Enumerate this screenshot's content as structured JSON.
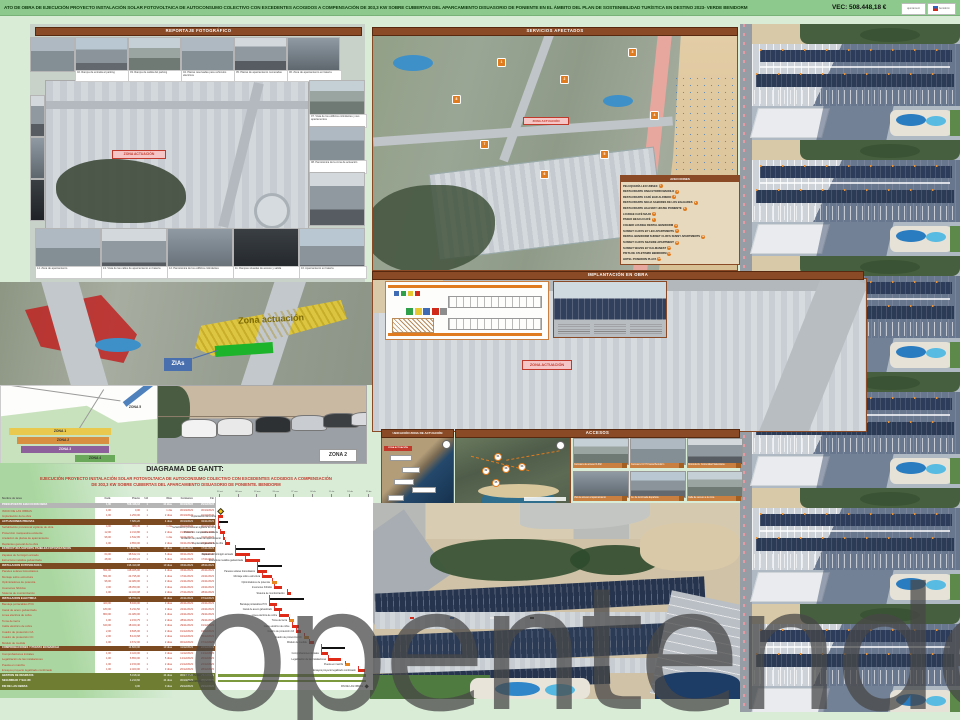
{
  "header": {
    "title": "ATO DE OBRA DE EJECUCIÓN PROYECTO INSTALACIÓN SOLAR FOTOVOLTAICA DE AUTOCONSUMO COLECTIVO CON EXCEDENTES ACOGIDOS A COMPENSACIÓN DE 303,3 KW SOBRE CUBIERTAS DEL APARCAMIENTO DISUASORIO DE PONIENTE EN EL ÁMBITO DEL PLAN DE SOSTENIBILIDAD TURÍSTICA EN DESTINO 2023- VERDE BENIDORM",
    "vec": "VEC: 508.448,18 €",
    "logo1": "ajuntament",
    "logo2": "benidorm"
  },
  "panels": {
    "reportaje": {
      "title": "REPORTAJE FOTOGRÁFICO",
      "zona_label": "ZONA ACTUACIÓN",
      "top_row": [
        "02. Rampa de entrada al parking",
        "03. Rampa de salida del parking",
        "04. Plazas reservadas para vehículos eléctricos",
        "05. Plazas de aparcamiento numeradas",
        "06. Zona de aparcamiento en batería"
      ],
      "right_col": [
        "07. Vista de los edificios colindantes y sus apartamentos",
        "08. Panorámica de la zona de actuación"
      ],
      "bottom_row": [
        "14. Zona de aparcamiento",
        "13. Vista de las calles de aparcamiento en batería",
        "12. Panorámica de los edificios colindantes",
        "11. Rampas situadas de acceso y salida",
        "16. Aparcamiento en batería"
      ]
    },
    "servicios": {
      "title": "SERVICIOS AFECTADOS",
      "zona_label": "ZONA ACTUACIÓN",
      "afecciones": {
        "title": "AFECCIONES",
        "items": [
          {
            "n": "1",
            "label": "PELUQUERÍA LEO UNISEX"
          },
          {
            "n": "2",
            "label": "RESTAURANTE ONGI ETORRI MANOLO"
          },
          {
            "n": "3",
            "label": "RESTAURANTE CAFÉ BAR ALFREDO"
          },
          {
            "n": "4",
            "label": "RESTAURANTE SIGUA SABORES DE LOS BALEARES"
          },
          {
            "n": "5",
            "label": "RESTAURANTE HALFWAY HOUSE PONIENTE"
          },
          {
            "n": "6",
            "label": "LOUNGE CAFÉ MAJO"
          },
          {
            "n": "7",
            "label": "PASEO BEACH CAFÉ"
          },
          {
            "n": "8",
            "label": "COLIBRI LOUNGE RENTAL BENIDORM"
          },
          {
            "n": "9",
            "label": "SUNSET CLIFFS BY LEO APARTMENTS"
          },
          {
            "n": "10",
            "label": "RENTAL BENIDORM SUNSET CLIFFS SUNNY APARTMENTS"
          },
          {
            "n": "11",
            "label": "SUNSET CLIFFS SEASIDE APARTMENT"
          },
          {
            "n": "12",
            "label": "SUNSET WAVES BY KALMANEST"
          },
          {
            "n": "13",
            "label": "PISTA DE ATLETISMO BENIDORM"
          },
          {
            "n": "14",
            "label": "HOTEL POSEIDON PLAYA"
          }
        ]
      },
      "markers": [
        {
          "n": "1",
          "x": 497,
          "y": 58
        },
        {
          "n": "2",
          "x": 560,
          "y": 75
        },
        {
          "n": "3",
          "x": 628,
          "y": 48
        },
        {
          "n": "4",
          "x": 650,
          "y": 111
        },
        {
          "n": "5",
          "x": 600,
          "y": 150
        },
        {
          "n": "6",
          "x": 540,
          "y": 170
        },
        {
          "n": "7",
          "x": 480,
          "y": 140
        },
        {
          "n": "8",
          "x": 452,
          "y": 95
        }
      ]
    },
    "implantacion": {
      "title": "IMPLANTACIÓN EN OBRA",
      "zona_label": "ZONA ACTUACIÓN"
    },
    "overlay": {
      "zona_actuacion": "Zona actuación",
      "zias": "ZIAs"
    },
    "zonas": {
      "z1": "ZONA 1",
      "z2": "ZONA 2",
      "z3": "ZONA 3",
      "z4": "ZONA 4",
      "z5": "ZONA 5",
      "photo_label": "ZONA 2"
    },
    "ubicacion": {
      "title": "UBICACIÓN ZONA DE ACTUACIÓN",
      "chip": "ZONA ACTUACIÓN"
    },
    "accesos": {
      "title": "ACCESOS",
      "photos": [
        "Carretera de acceso N-332",
        "Carretera CV-70 hacia Benidorm",
        "Rotonda Av. Comunidad Valenciana",
        "Vial de acceso al aparcamiento",
        "Av. de la Armada Española",
        "Calle de acceso a la zona"
      ],
      "markers": [
        "01",
        "02",
        "03",
        "04",
        "05"
      ]
    }
  },
  "gantt": {
    "title": "DIAGRAMA DE GANTT:",
    "subtitle1": "EJECUCIÓN PROYECTO INSTALACIÓN SOLAR FOTOVOLTAICA DE AUTOCONSUMO COLECTIVO CON EXCEDENTES ACOGIDOS A COMPENSACIÓN",
    "subtitle2": "DE 303,3 KW SOBRE CUBIERTAS DEL APARCAMIENTO DISUASORIO DE PONIENTE. BENIDORM",
    "columns": [
      "Nombre de tarea",
      "Cant.",
      "Precio",
      "Ud",
      "Días",
      "Comienzo",
      "Fin"
    ],
    "unit": "1",
    "ticks": [
      "30 oct",
      "06 nov",
      "13 nov",
      "20 nov",
      "27 nov",
      "04 dic",
      "11 dic",
      "18 dic",
      "25 dic"
    ],
    "total": {
      "t": "total",
      "l": "PRESUPUESTO EJECUCIÓN OBRA",
      "q": "1,00",
      "p": "508.448,18",
      "d": "44 días",
      "s": "30/10/2023",
      "e": "29/12/2023"
    },
    "rows": [
      {
        "t": "task",
        "l": "INICIO DE LAS OBRAS",
        "q": "1,00",
        "p": "0,00",
        "d": "1 día",
        "s": "30/10/2023",
        "e": "30/10/2023",
        "m": "start"
      },
      {
        "t": "task",
        "l": "Implantación de la obra",
        "q": "1,00",
        "p": "1.250,00",
        "d": "2 días",
        "s": "30/10/2023",
        "e": "31/10/2023"
      },
      {
        "t": "sec",
        "l": "ACTUACIONES PREVIAS",
        "p": "7.684,20",
        "d": "4 días",
        "s": "30/10/2023",
        "e": "02/11/2023"
      },
      {
        "t": "task",
        "l": "Señalización provisional vigilante de obra",
        "q": "4,00",
        "p": "980,45",
        "d": "1 día",
        "s": "30/10/2023",
        "e": "30/10/2023"
      },
      {
        "t": "task",
        "l": "Protección marquesina existente",
        "q": "12,00",
        "p": "2.310,80",
        "d": "2 días",
        "s": "31/10/2023",
        "e": "01/11/2023"
      },
      {
        "t": "task",
        "l": "Anulación de plazas de aparcamiento",
        "q": "96,00",
        "p": "1.542,95",
        "d": "1 día",
        "s": "01/11/2023",
        "e": "01/11/2023"
      },
      {
        "t": "task",
        "l": "Replanteo general de la obra",
        "q": "1,00",
        "p": "2.850,00",
        "d": "2 días",
        "s": "02/11/2023",
        "e": "03/11/2023"
      },
      {
        "t": "sec",
        "l": "ESTRUCTURA SOPORTE PANELES FOTOVOLTAICOS",
        "p": "178.902,55",
        "d": "12 días",
        "s": "06/11/2023",
        "e": "17/11/2023"
      },
      {
        "t": "task",
        "l": "Zapatas de hormigón armado",
        "q": "64,00",
        "p": "38.642,31",
        "d": "6 días",
        "s": "06/11/2023",
        "e": "13/11/2023"
      },
      {
        "t": "task",
        "l": "Estructura metálica galvanizada",
        "q": "48,00",
        "p": "140.260,24",
        "d": "6 días",
        "s": "10/11/2023",
        "e": "17/11/2023"
      },
      {
        "t": "sec",
        "l": "INSTALACIÓN FOTOVOLTAICA",
        "p": "196.410,08",
        "d": "10 días",
        "s": "15/11/2023",
        "e": "28/11/2023"
      },
      {
        "t": "task",
        "l": "Paneles solares fotovoltaicos",
        "q": "551,00",
        "p": "118.465,00",
        "d": "4 días",
        "s": "15/11/2023",
        "e": "20/11/2023"
      },
      {
        "t": "task",
        "l": "Montaje sobre estructura",
        "q": "551,00",
        "p": "24.795,00",
        "d": "4 días",
        "s": "17/11/2023",
        "e": "22/11/2023"
      },
      {
        "t": "task",
        "l": "Optimizadores de potencia",
        "q": "96,00",
        "p": "12.480,00",
        "d": "2 días",
        "s": "21/11/2023",
        "e": "22/11/2023",
        "o": true
      },
      {
        "t": "task",
        "l": "Inversores híbridos",
        "q": "3,00",
        "p": "28.350,00",
        "d": "3 días",
        "s": "22/11/2023",
        "e": "24/11/2023"
      },
      {
        "t": "task",
        "l": "Sistema de monitorización",
        "q": "1,00",
        "p": "12.320,08",
        "d": "2 días",
        "s": "27/11/2023",
        "e": "28/11/2023"
      },
      {
        "t": "sec",
        "l": "INSTALACIÓN ELÉCTRICA",
        "p": "98.764,33",
        "d": "14 días",
        "s": "20/11/2023",
        "e": "07/12/2023"
      },
      {
        "t": "task",
        "l": "Bandeja portacables PVC",
        "q": "420,00",
        "p": "8.940,00",
        "d": "3 días",
        "s": "20/11/2023",
        "e": "22/11/2023"
      },
      {
        "t": "task",
        "l": "Canal de acero galvanizado",
        "q": "180,00",
        "p": "6.234,50",
        "d": "3 días",
        "s": "22/11/2023",
        "e": "24/11/2023"
      },
      {
        "t": "task",
        "l": "Línea eléctrica de cobre",
        "q": "860,00",
        "p": "21.480,00",
        "d": "4 días",
        "s": "24/11/2023",
        "e": "29/11/2023"
      },
      {
        "t": "task",
        "l": "Toma de tierra",
        "q": "1,00",
        "p": "2.150,75",
        "d": "2 días",
        "s": "28/11/2023",
        "e": "29/11/2023",
        "o": true
      },
      {
        "t": "task",
        "l": "Cable eléctrico de cobre",
        "q": "640,00",
        "p": "18.320,40",
        "d": "3 días",
        "s": "29/11/2023",
        "e": "01/12/2023"
      },
      {
        "t": "task",
        "l": "Cuadro de protección CA",
        "q": "2,00",
        "p": "9.845,00",
        "d": "2 días",
        "s": "01/12/2023",
        "e": "04/12/2023"
      },
      {
        "t": "task",
        "l": "Cuadro de protección CC",
        "q": "2,00",
        "p": "8.120,68",
        "d": "2 días",
        "s": "04/12/2023",
        "e": "05/12/2023",
        "o": true
      },
      {
        "t": "task",
        "l": "Módulo de medida",
        "q": "1,00",
        "p": "3.672,00",
        "d": "2 días",
        "s": "06/12/2023",
        "e": "07/12/2023"
      },
      {
        "t": "sec",
        "l": "COMPROBACIONES Y PUESTA EN MARCHA",
        "p": "14.820,00",
        "d": "10 días",
        "s": "11/12/2023",
        "e": "22/12/2023"
      },
      {
        "t": "task",
        "l": "Comprobaciones iniciales",
        "q": "1,00",
        "p": "3.420,00",
        "d": "3 días",
        "s": "11/12/2023",
        "e": "13/12/2023"
      },
      {
        "t": "task",
        "l": "Legalización de las instalaciones",
        "q": "1,00",
        "p": "6.850,00",
        "d": "5 días",
        "s": "14/12/2023",
        "e": "20/12/2023"
      },
      {
        "t": "task",
        "l": "Puesta en marcha",
        "q": "1,00",
        "p": "2.150,00",
        "d": "2 días",
        "s": "21/12/2023",
        "e": "22/12/2023",
        "o": true
      },
      {
        "t": "task",
        "l": "Ensayos proyecto legalizado combinado",
        "q": "1,00",
        "p": "2.400,00",
        "d": "3 días",
        "s": "26/12/2023",
        "e": "28/12/2023"
      },
      {
        "t": "olive",
        "l": "GESTIÓN DE RESIDUOS",
        "p": "5.318,42",
        "d": "44 días",
        "s": "30/10/2023",
        "e": "29/12/2023"
      },
      {
        "t": "olive",
        "l": "SEGURIDAD Y SALUD",
        "p": "4.210,60",
        "d": "44 días",
        "s": "30/10/2023",
        "e": "29/12/2023"
      },
      {
        "t": "olive",
        "l": "FIN DE LAS OBRAS",
        "p": "0,00",
        "d": "0 días",
        "s": "29/12/2023",
        "e": "29/12/2023",
        "m": "end"
      }
    ]
  },
  "watermark": "opentenders"
}
